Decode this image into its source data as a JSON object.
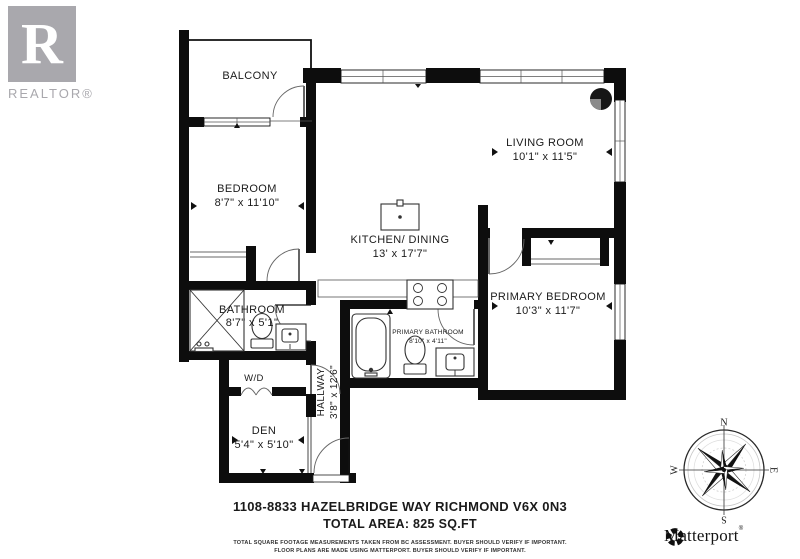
{
  "branding": {
    "realtor_letter": "R",
    "realtor_text": "REALTOR®",
    "matterport_text": "Matterport",
    "matterport_reg": "®"
  },
  "rooms": {
    "balcony": {
      "label": "BALCONY"
    },
    "bedroom": {
      "label": "BEDROOM",
      "dims": "8'7\" x 11'10\""
    },
    "living_room": {
      "label": "LIVING ROOM",
      "dims": "10'1\" x 11'5\""
    },
    "kitchen_dining": {
      "label": "KITCHEN/ DINING",
      "dims": "13' x 17'7\""
    },
    "bathroom": {
      "label": "BATHROOM",
      "dims": "8'7\" x 5'1\""
    },
    "primary_bedroom": {
      "label": "PRIMARY BEDROOM",
      "dims": "10'3\" x 11'7\""
    },
    "primary_bathroom": {
      "label": "PRIMARY BATHROOM",
      "dims": "8'10\" x 4'11\""
    },
    "hallway": {
      "label": "HALLWAY",
      "dims": "3'8\" x 12'6\""
    },
    "wd": {
      "label": "W/D"
    },
    "den": {
      "label": "DEN",
      "dims": "5'4\" x 5'10\""
    }
  },
  "compass": {
    "n": "N",
    "e": "E",
    "s": "S",
    "w": "W"
  },
  "footer": {
    "address": "1108-8833 HAZELBRIDGE WAY RICHMOND V6X 0N3",
    "total_area": "TOTAL AREA: 825 SQ.FT",
    "disclaimer_line1": "TOTAL SQUARE FOOTAGE MEASUREMENTS TAKEN FROM BC ASSESSMENT. BUYER SHOULD VERIFY IF IMPORTANT.",
    "disclaimer_line2": "FLOOR PLANS ARE MADE USING MATTERPORT. BUYER SHOULD VERIFY IF IMPORTANT."
  },
  "colors": {
    "wall": "#0d0d0d",
    "logo_gray": "#a9a8ad",
    "closet_rod_gray": "#9a9a9a"
  },
  "icons": {
    "realtor": "realtor-r-logo",
    "matterport": "matterport-pinwheel-icon",
    "compass": "compass-rose-icon"
  }
}
